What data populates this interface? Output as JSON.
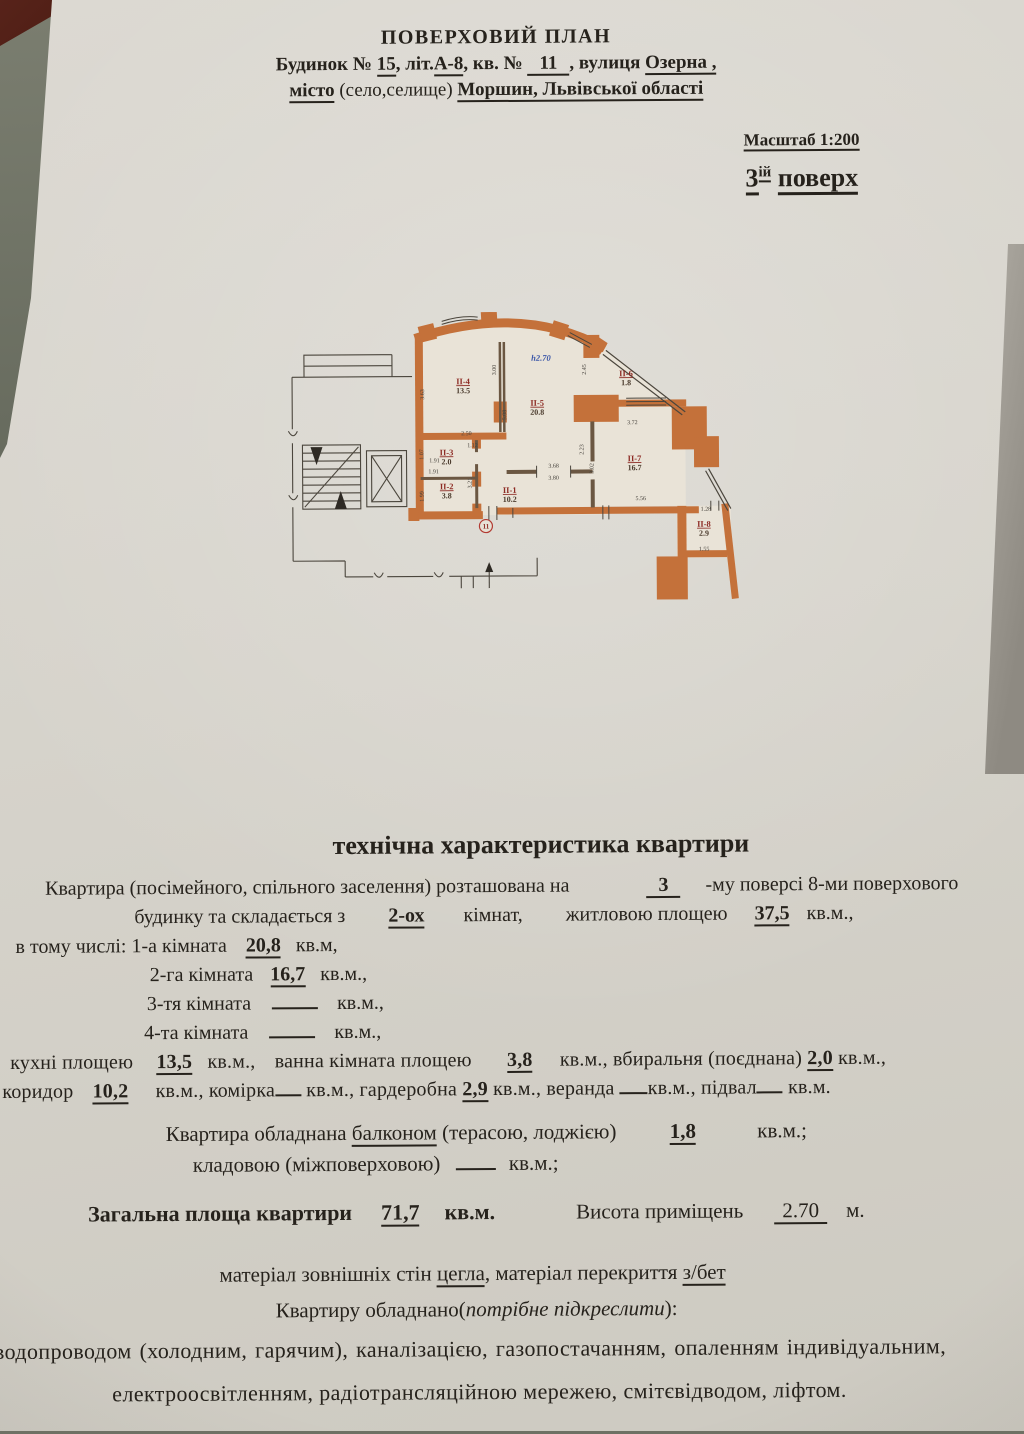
{
  "header": {
    "title": "ПОВЕРХОВИЙ ПЛАН",
    "address1": {
      "a": "Будинок №",
      "v1": "15",
      "b": ", літ.",
      "v2": "А-8",
      "c": ", кв. №",
      "v3": "11",
      "d": ", вулиця",
      "v4": "Озерна ,"
    },
    "address2": {
      "v1": "місто",
      "a": "(село,селище)",
      "v2": "Моршин, Львівської області"
    },
    "scale": "Масштаб 1:200",
    "floor": {
      "num": "3",
      "sup": "ій",
      "word": "поверх"
    }
  },
  "side_paper": {
    "vykh": "вих. №047",
    "frag1": "8",
    "frag2": "р/",
    "frag3": "К",
    "frag4": "Т"
  },
  "plan": {
    "height_mark": "h2.70",
    "entrance_mark": "11",
    "rooms": [
      {
        "id": "ІІ-1",
        "area": "10.2"
      },
      {
        "id": "ІІ-2",
        "area": "3.8"
      },
      {
        "id": "ІІ-3",
        "area": "2.0"
      },
      {
        "id": "ІІ-4",
        "area": "13.5"
      },
      {
        "id": "ІІ-5",
        "area": "20.8"
      },
      {
        "id": "ІІ-6",
        "area": "1.8"
      },
      {
        "id": "ІІ-7",
        "area": "16.7"
      },
      {
        "id": "ІІ-8",
        "area": "2.9"
      }
    ],
    "dims": [
      "3.63",
      "3.00",
      "5.08",
      "2.45",
      "2.23",
      "3.02",
      "2.50",
      "1.12",
      "1.91",
      "1.91",
      "1.07",
      "1.99",
      "3.21",
      "3.68",
      "3.80",
      "3.72",
      "5.56",
      "1.28",
      "1.55"
    ]
  },
  "tech": {
    "heading": "технічна характеристика квартири",
    "p1": {
      "a": "Квартира (посімейного, спільного заселення) розташована на",
      "v": "3",
      "b": "-му  поверсі 8-ми поверхового"
    },
    "p2": {
      "a": "будинку та складається з",
      "v1": "2-ох",
      "b": "кімнат,",
      "c": "житловою площею",
      "v2": "37,5",
      "d": "кв.м.,"
    },
    "p3": {
      "a": "в тому числі: 1-а кімната",
      "v": "20,8",
      "b": "кв.м,"
    },
    "p4": {
      "a": "2-га кімната",
      "v": "16,7",
      "b": "кв.м.,"
    },
    "p5": {
      "a": "3-тя кімната",
      "b": "кв.м.,"
    },
    "p6": {
      "a": "4-та кімната",
      "b": "кв.м.,"
    },
    "p7": {
      "a": "кухні площею",
      "v1": "13,5",
      "b": "кв.м.,",
      "c": "ванна кімната площею",
      "v2": "3,8",
      "d": "кв.м.,",
      "e": "вбиральня (поєднана)",
      "v3": "2,0",
      "f": "кв.м.,"
    },
    "p8": {
      "a": "коридор",
      "v1": "10,2",
      "b": "кв.м., комірка",
      "c": "кв.м., гардеробна",
      "v2": "2,9",
      "d": "кв.м., веранда",
      "e": "кв.м., підвал",
      "f": "кв.м."
    },
    "p9": {
      "a": "Квартира обладнана",
      "v1": "балконом",
      "b": "(терасою, лоджією)",
      "v2": "1,8",
      "c": "кв.м.;"
    },
    "p10": {
      "a": "кладовою (міжповерховою)",
      "b": "кв.м.;"
    },
    "p11": {
      "a": "Загальна площа квартири",
      "v1": "71,7",
      "b": "кв.м.",
      "c": "Висота приміщень",
      "v2": "2.70",
      "d": "м."
    },
    "p12": {
      "a": "матеріал зовнішніх стін",
      "v1": "цегла",
      "b": ", матеріал перекриття",
      "v2": "з/бет"
    },
    "p13": {
      "a": "Квартиру обладнано(",
      "em": "потрібне підкреслити",
      "b": "):"
    },
    "p14": "водопроводом (холодним, гарячим), каналізацією, газопостачанням, опаленням  індивідуальним,",
    "p15": "електроосвітленням, радіотрансляційною мережею, смітєвідводом, ліфтом."
  }
}
